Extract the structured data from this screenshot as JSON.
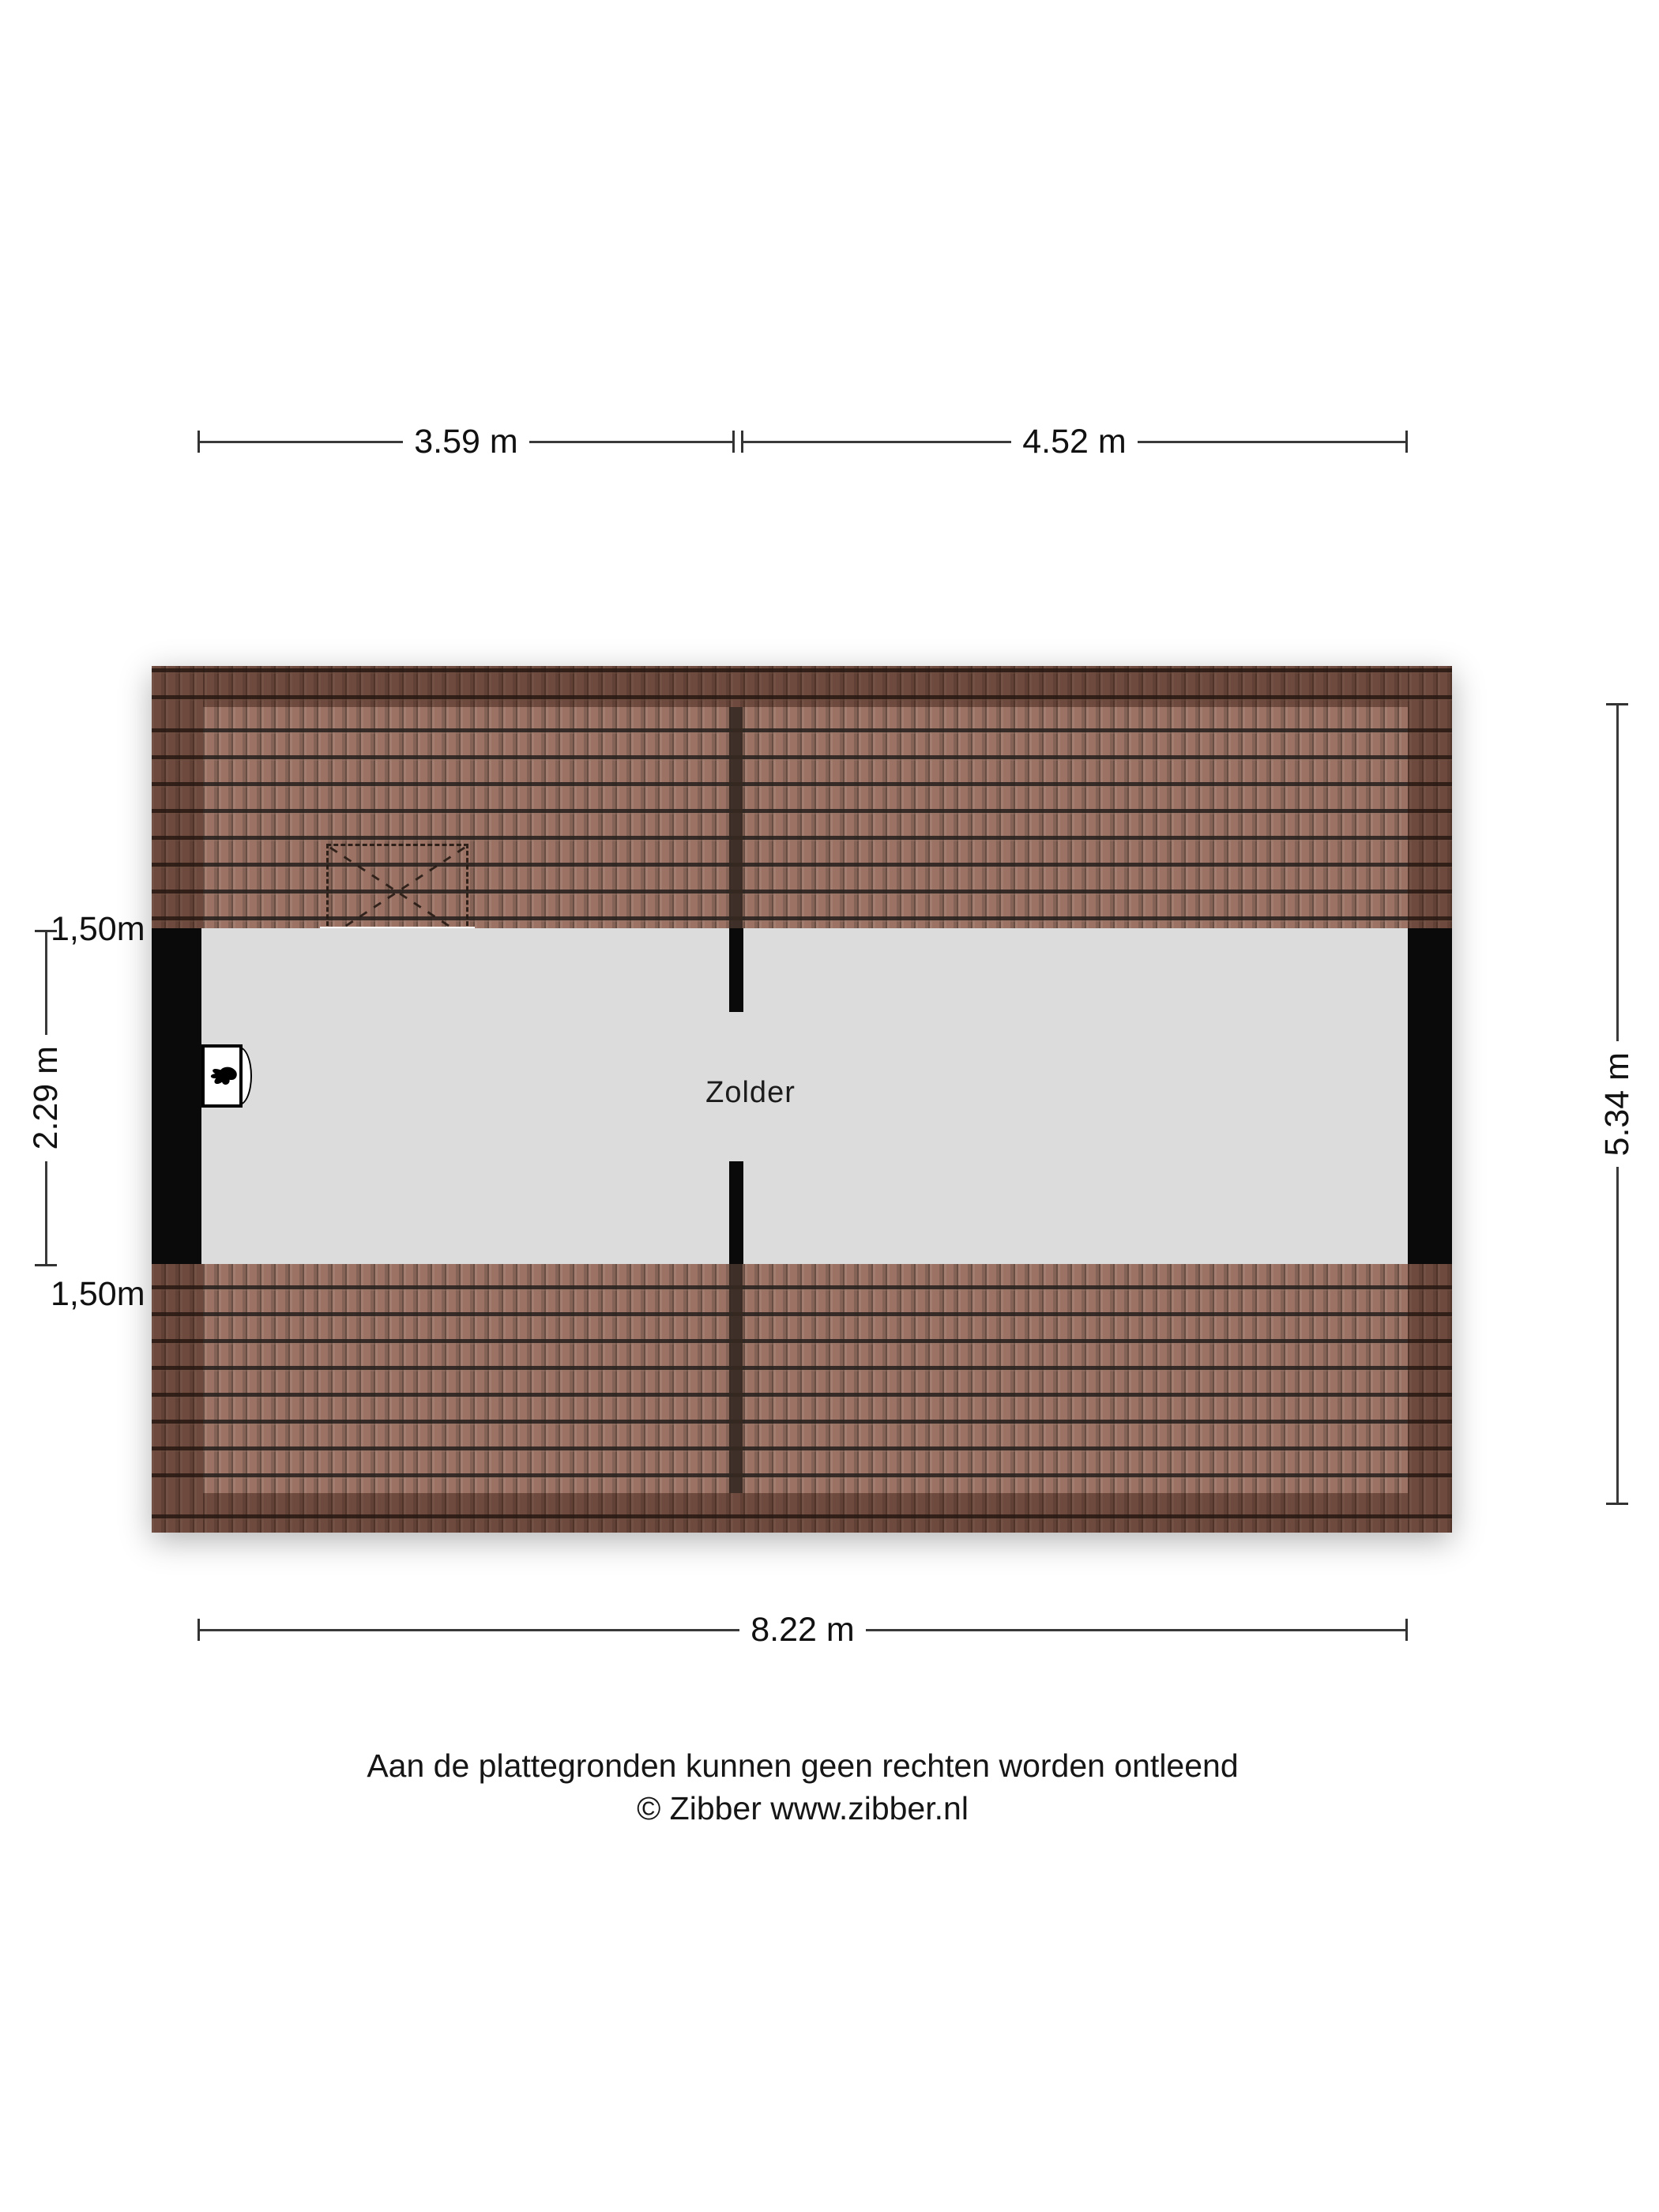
{
  "floorplan": {
    "type": "attic floor plan",
    "room_label": "Zolder",
    "dimensions": {
      "top_left": "3.59 m",
      "top_right": "4.52 m",
      "bottom": "8.22 m",
      "left_total": "2.29 m",
      "left_upper": "1,50m",
      "left_lower": "1,50m",
      "right": "5.34 m"
    },
    "icons": {
      "boiler": "boiler-flame-icon",
      "roof_window": "dashed-roof-window-icon"
    },
    "colors": {
      "page_bg": "#ffffff",
      "floor": "#dcdcdc",
      "wall": "#0a0a0a",
      "tile_base": "#9b7264",
      "tile_line": "#282120",
      "roof_edge_overlay": "rgba(43,16,6,0.40)",
      "dim_line": "#3a3a3a",
      "text": "#111111"
    }
  },
  "footer": {
    "line1": "Aan de plattegronden kunnen geen rechten worden ontleend",
    "line2": "© Zibber www.zibber.nl"
  }
}
